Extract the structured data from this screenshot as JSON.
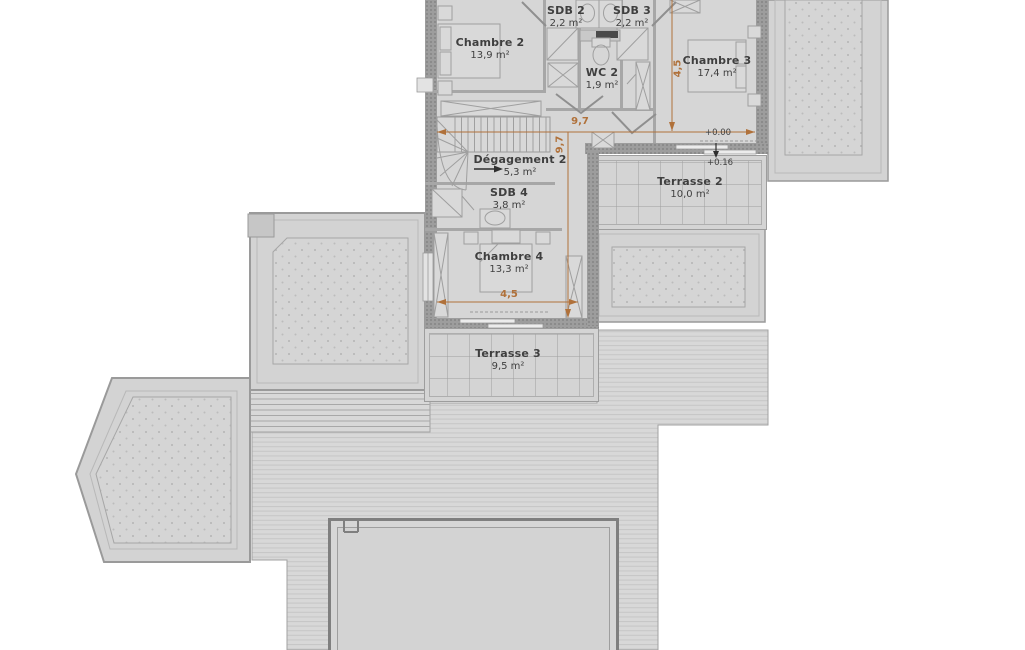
{
  "rooms": [
    {
      "id": "chambre-2",
      "name": "Chambre 2",
      "area": "13,9 m²"
    },
    {
      "id": "sdb-2",
      "name": "SDB 2",
      "area": "2,2 m²"
    },
    {
      "id": "sdb-3",
      "name": "SDB 3",
      "area": "2,2 m²"
    },
    {
      "id": "wc-2",
      "name": "WC 2",
      "area": "1,9 m²"
    },
    {
      "id": "chambre-3",
      "name": "Chambre 3",
      "area": "17,4 m²"
    },
    {
      "id": "degagement-2",
      "name": "Dégagement 2",
      "area": "5,3 m²"
    },
    {
      "id": "sdb-4",
      "name": "SDB 4",
      "area": "3,8 m²"
    },
    {
      "id": "chambre-4",
      "name": "Chambre 4",
      "area": "13,3 m²"
    },
    {
      "id": "terrasse-2",
      "name": "Terrasse 2",
      "area": "10,0 m²"
    },
    {
      "id": "terrasse-3",
      "name": "Terrasse 3",
      "area": "9,5 m²"
    }
  ],
  "dimensions": [
    {
      "label": "9,7",
      "orientation": "horizontal"
    },
    {
      "label": "9,7",
      "orientation": "vertical"
    },
    {
      "label": "4,5",
      "orientation": "vertical"
    },
    {
      "label": "4,5",
      "orientation": "horizontal"
    }
  ],
  "elevations": [
    {
      "label": "+0.00"
    },
    {
      "label": "+0.16"
    }
  ],
  "colors": {
    "dimension_accent": "#b0713a",
    "label_text": "#3f3f3f",
    "plan_fill": "#d6d6d6",
    "wall": "#9d9d9d"
  }
}
